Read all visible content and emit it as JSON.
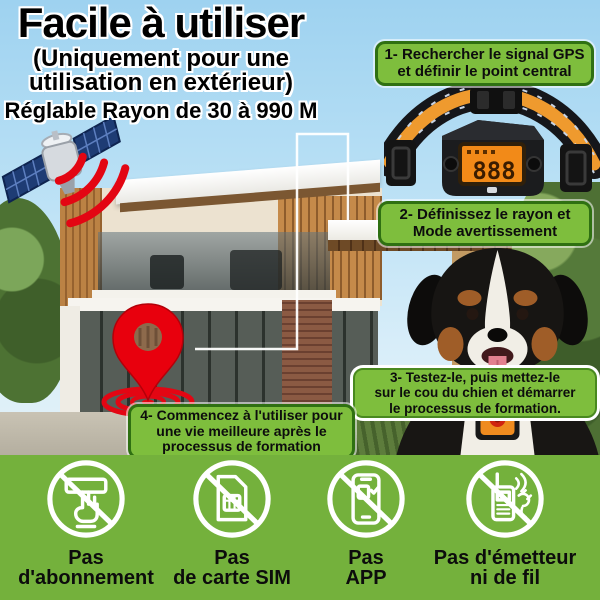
{
  "header": {
    "title": "Facile à utiliser",
    "subtitle": "(Uniquement pour une\nutilisation en extérieur)",
    "range_note": "Réglable Rayon de 30 à 990 M"
  },
  "steps": {
    "step1": "1- Rechercher le signal GPS\net définir le point central",
    "step2": "2- Définissez le rayon et\nMode avertissement",
    "step3": "3- Testez-le, puis mettez-le\nsur le cou du chien et démarrer\nle processus de formation.",
    "step4": "4- Commencez à l'utiliser pour\nune vie meilleure après le\nprocessus de formation"
  },
  "collar": {
    "screen_value": "888"
  },
  "features": {
    "no_subscription": "Pas\nd'abonnement",
    "no_sim": "Pas\nde carte SIM",
    "no_app": "Pas\nAPP",
    "no_transmitter": "Pas d'émetteur\nni de fil"
  },
  "icons": {
    "satellite": "satellite-icon",
    "gps_signal": "signal-waves-icon",
    "location_pin": "location-pin-icon",
    "collar_device": "gps-collar-device",
    "dog": "dog-wearing-collar",
    "no_subscription": "no-subscription-icon",
    "no_sim": "no-sim-card-icon",
    "no_app": "no-app-icon",
    "no_transmitter": "no-transmitter-icon"
  },
  "colors": {
    "step_box_fill": "#7ebe3d",
    "step_box_border": "#2f7012",
    "footer_background": "#74b13c",
    "sky": "#b9e0f5",
    "signal_red": "#e30613",
    "screen_orange": "#f28a18",
    "strap_orange": "#ef9a2e",
    "text_black": "#0d0d0d"
  }
}
